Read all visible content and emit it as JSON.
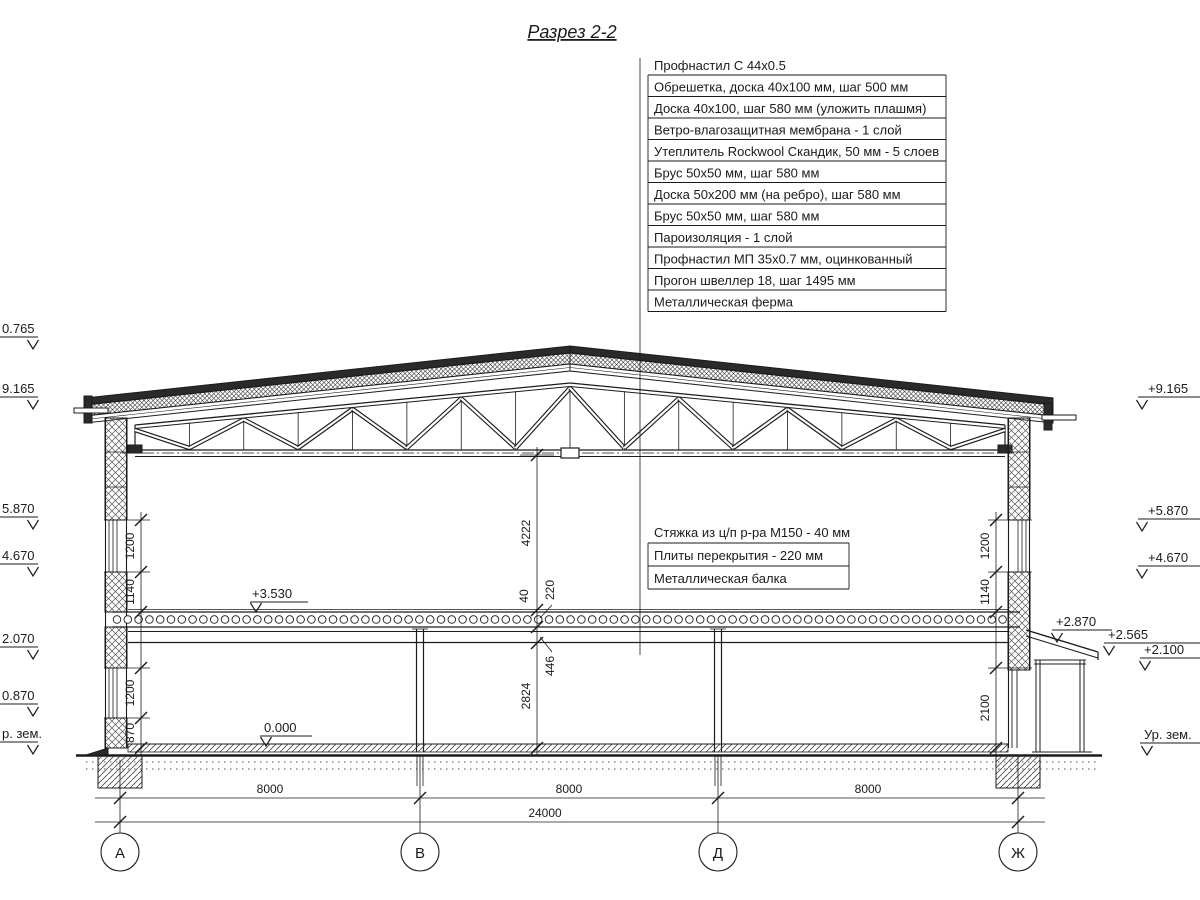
{
  "title": "Разрез 2-2",
  "roof_callouts": [
    "Профнастил С 44х0.5",
    "Обрешетка, доска 40х100 мм, шаг 500 мм",
    "Доска 40х100, шаг 580 мм (уложить плашмя)",
    "Ветро-влагозащитная мембрана - 1 слой",
    "Утеплитель Rockwool Скандик, 50 мм - 5 слоев",
    "Брус 50х50 мм, шаг 580 мм",
    "Доска 50х200 мм (на ребро), шаг 580 мм",
    "Брус 50х50 мм, шаг 580 мм",
    "Пароизоляция - 1 слой",
    "Профнастил МП 35х0.7 мм, оцинкованный",
    "Прогон швеллер 18, шаг 1495 мм",
    "Металлическая ферма"
  ],
  "floor_callouts": [
    "Стяжка из ц/п р-ра М150 - 40 мм",
    "Плиты перекрытия - 220 мм",
    "Металлическая балка"
  ],
  "elevations_left": [
    "0.765",
    "9.165",
    "5.870",
    "4.670",
    "2.070",
    "0.870",
    "р. зем."
  ],
  "elevations_right": [
    "+9.165",
    "+5.870",
    "+4.670",
    "+2.870",
    "+2.565",
    "+2.100",
    "Ур. зем."
  ],
  "floor_marks": {
    "second_floor": "+3.530",
    "ground_floor": "0.000"
  },
  "dims": {
    "bottom": [
      "8000",
      "8000",
      "8000",
      "24000"
    ],
    "left_chain": [
      "1200",
      "1140",
      "1200",
      "870"
    ],
    "right_chain": [
      "1200",
      "1140",
      "2100"
    ],
    "center_chain": [
      "4222",
      "40",
      "220",
      "446",
      "2824"
    ]
  },
  "grid_axes": [
    "А",
    "В",
    "Д",
    "Ж"
  ]
}
